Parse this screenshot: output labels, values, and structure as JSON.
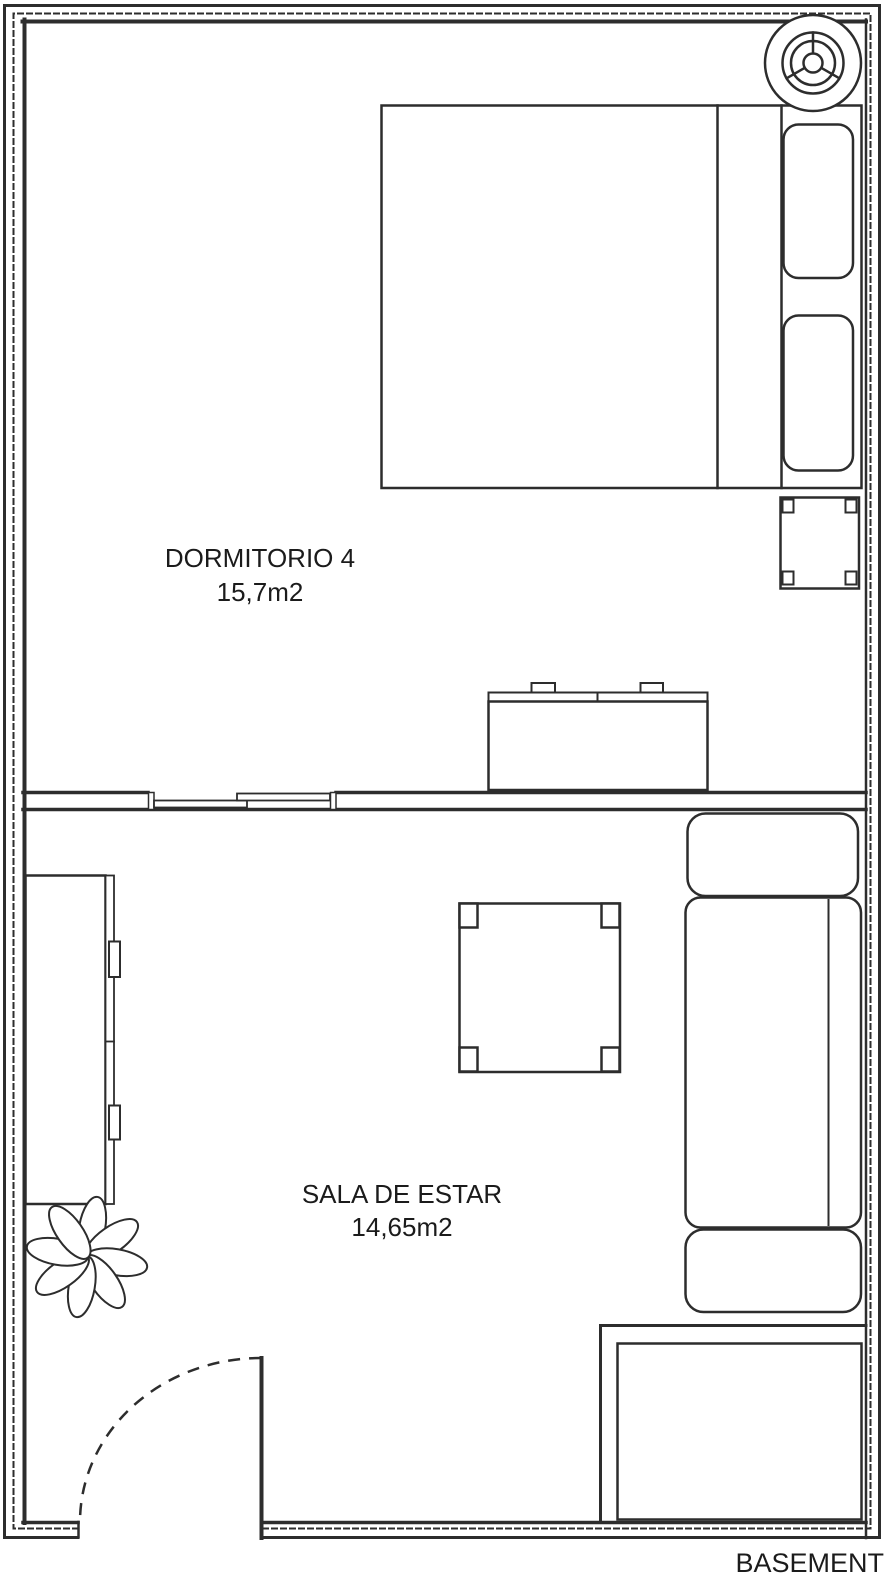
{
  "colors": {
    "line": "#2d2d2d",
    "text": "#1b1b1b",
    "background": "#ffffff"
  },
  "rooms": [
    {
      "name": "DORMITORIO 4",
      "area": "15,7m2"
    },
    {
      "name": "SALA DE ESTAR",
      "area": "14,65m2"
    }
  ],
  "footer_label": "BASEMENT",
  "furniture_icons": [
    "ceiling-fan-icon",
    "double-bed",
    "pillow",
    "nightstand",
    "dresser",
    "sliding-door",
    "wardrobe",
    "potted-plant",
    "coffee-table",
    "sofa",
    "entry-door-arc",
    "basement-void"
  ]
}
